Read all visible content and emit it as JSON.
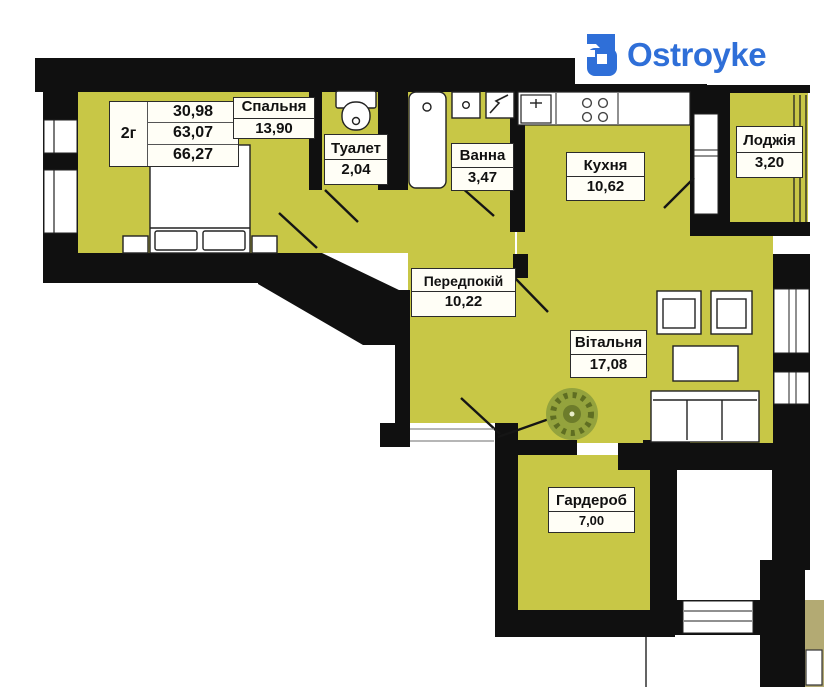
{
  "logo": {
    "text": "Ostroyke"
  },
  "summary_table": {
    "type_label": "2г",
    "values": [
      "30,98",
      "63,07",
      "66,27"
    ]
  },
  "rooms": [
    {
      "id": "bedroom",
      "name": "Спальня",
      "area": "13,90"
    },
    {
      "id": "toilet",
      "name": "Туалет",
      "area": "2,04"
    },
    {
      "id": "bath",
      "name": "Ванна",
      "area": "3,47"
    },
    {
      "id": "kitchen",
      "name": "Кухня",
      "area": "10,62"
    },
    {
      "id": "loggia",
      "name": "Лоджія",
      "area": "3,20"
    },
    {
      "id": "hallway",
      "name": "Передпокій",
      "area": "10,22"
    },
    {
      "id": "living",
      "name": "Вітальня",
      "area": "17,08"
    },
    {
      "id": "wardrobe",
      "name": "Гардероб",
      "area": "7,00"
    }
  ],
  "colors": {
    "floor": "#c8c746",
    "wall": "#101010",
    "brand_blue": "#2f6fd8",
    "adjacent_floor": "#b3aa73",
    "plant_green": "#94a33d"
  }
}
